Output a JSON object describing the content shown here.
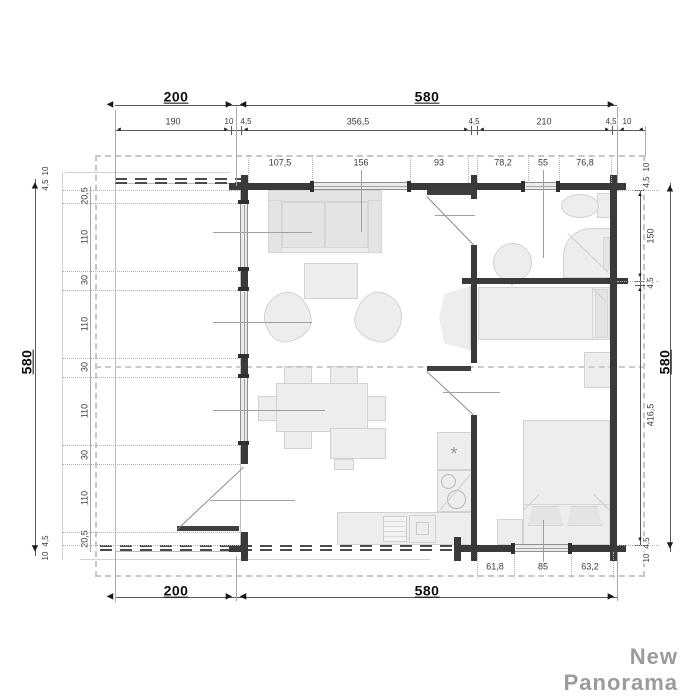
{
  "brand": "New Panorama",
  "symbols": {
    "kitchen_star": "*"
  },
  "colors": {
    "wall": "#3a3a3a",
    "furniture_fill": "#ededed",
    "furniture_border": "#d2d2d2",
    "dimension_text": "#3a3a3a",
    "overall_dimension_text": "#0d0d0d",
    "watermark": "#9b9b9b",
    "roof_dash": "#c7c7c7"
  },
  "overall_dimensions": {
    "terrace_width": "200",
    "cabin_width": "580",
    "depth_left": "580",
    "depth_right": "580"
  },
  "plan": {
    "labels": [
      {
        "t": "200",
        "x": 176,
        "y": 97,
        "b": 1
      },
      {
        "t": "580",
        "x": 427,
        "y": 97,
        "b": 1
      },
      {
        "t": "190",
        "x": 173,
        "y": 122
      },
      {
        "t": "10",
        "x": 229,
        "y": 122,
        "s": 1
      },
      {
        "t": "4,5",
        "x": 246,
        "y": 122,
        "s": 1
      },
      {
        "t": "356,5",
        "x": 358,
        "y": 122
      },
      {
        "t": "4,5",
        "x": 474,
        "y": 122,
        "s": 1
      },
      {
        "t": "210",
        "x": 544,
        "y": 122
      },
      {
        "t": "4,5",
        "x": 611,
        "y": 122,
        "s": 1
      },
      {
        "t": "10",
        "x": 627,
        "y": 122,
        "s": 1
      },
      {
        "t": "107,5",
        "x": 280,
        "y": 163
      },
      {
        "t": "156",
        "x": 361,
        "y": 163
      },
      {
        "t": "93",
        "x": 439,
        "y": 163
      },
      {
        "t": "78,2",
        "x": 503,
        "y": 163
      },
      {
        "t": "55",
        "x": 543,
        "y": 163
      },
      {
        "t": "76,8",
        "x": 585,
        "y": 163
      },
      {
        "t": "10",
        "x": 46,
        "y": 171,
        "r": 1,
        "s": 1
      },
      {
        "t": "4,5",
        "x": 46,
        "y": 185,
        "r": 1,
        "s": 1
      },
      {
        "t": "20,5",
        "x": 85,
        "y": 196,
        "r": 1
      },
      {
        "t": "110",
        "x": 85,
        "y": 237,
        "r": 1
      },
      {
        "t": "30",
        "x": 85,
        "y": 280,
        "r": 1
      },
      {
        "t": "110",
        "x": 85,
        "y": 324,
        "r": 1
      },
      {
        "t": "30",
        "x": 85,
        "y": 367,
        "r": 1
      },
      {
        "t": "110",
        "x": 85,
        "y": 411,
        "r": 1
      },
      {
        "t": "30",
        "x": 85,
        "y": 455,
        "r": 1
      },
      {
        "t": "110",
        "x": 85,
        "y": 498,
        "r": 1
      },
      {
        "t": "20,5",
        "x": 85,
        "y": 539,
        "r": 1
      },
      {
        "t": "4,5",
        "x": 46,
        "y": 541,
        "r": 1,
        "s": 1
      },
      {
        "t": "10",
        "x": 46,
        "y": 556,
        "r": 1,
        "s": 1
      },
      {
        "t": "580",
        "x": 27,
        "y": 362,
        "r": 1,
        "b": 1
      },
      {
        "t": "10",
        "x": 647,
        "y": 167,
        "r": 1,
        "s": 1
      },
      {
        "t": "4,5",
        "x": 647,
        "y": 182,
        "r": 1,
        "s": 1
      },
      {
        "t": "150",
        "x": 651,
        "y": 236,
        "r": 1
      },
      {
        "t": "4,5",
        "x": 651,
        "y": 283,
        "r": 1,
        "s": 1
      },
      {
        "t": "416,5",
        "x": 651,
        "y": 415,
        "r": 1
      },
      {
        "t": "4,5",
        "x": 647,
        "y": 543,
        "r": 1,
        "s": 1
      },
      {
        "t": "10",
        "x": 647,
        "y": 558,
        "r": 1,
        "s": 1
      },
      {
        "t": "580",
        "x": 665,
        "y": 362,
        "r": 1,
        "b": 1
      },
      {
        "t": "61,8",
        "x": 495,
        "y": 567
      },
      {
        "t": "85",
        "x": 543,
        "y": 567
      },
      {
        "t": "63,2",
        "x": 590,
        "y": 567
      },
      {
        "t": "200",
        "x": 176,
        "y": 591,
        "b": 1
      },
      {
        "t": "580",
        "x": 427,
        "y": 591,
        "b": 1
      }
    ],
    "arrows": [
      {
        "g": "◄",
        "x": 110,
        "y": 105
      },
      {
        "g": "►",
        "x": 229,
        "y": 105
      },
      {
        "g": "◄",
        "x": 243,
        "y": 105
      },
      {
        "g": "►",
        "x": 611,
        "y": 105
      },
      {
        "g": "◄",
        "x": 110,
        "y": 597
      },
      {
        "g": "►",
        "x": 229,
        "y": 597
      },
      {
        "g": "◄",
        "x": 243,
        "y": 597
      },
      {
        "g": "►",
        "x": 611,
        "y": 597
      },
      {
        "g": "▲",
        "x": 35,
        "y": 186
      },
      {
        "g": "▼",
        "x": 35,
        "y": 549
      },
      {
        "g": "▲",
        "x": 670,
        "y": 189
      },
      {
        "g": "▼",
        "x": 670,
        "y": 546
      },
      {
        "g": "◄",
        "x": 119,
        "y": 130,
        "z": 6
      },
      {
        "g": "►",
        "x": 226,
        "y": 130,
        "z": 6
      },
      {
        "g": "◄",
        "x": 246,
        "y": 130,
        "z": 6
      },
      {
        "g": "►",
        "x": 466,
        "y": 130,
        "z": 6
      },
      {
        "g": "◄",
        "x": 482,
        "y": 130,
        "z": 6
      },
      {
        "g": "►",
        "x": 607,
        "y": 130,
        "z": 6
      },
      {
        "g": "◄",
        "x": 622,
        "y": 130,
        "z": 6
      },
      {
        "g": "◄",
        "x": 641,
        "y": 130,
        "z": 6
      },
      {
        "g": "▲",
        "x": 640,
        "y": 195,
        "z": 6
      },
      {
        "g": "▼",
        "x": 640,
        "y": 276,
        "z": 6
      },
      {
        "g": "▲",
        "x": 640,
        "y": 290,
        "z": 6
      },
      {
        "g": "▼",
        "x": 640,
        "y": 540,
        "z": 6
      }
    ],
    "lines": {
      "dim": [
        {
          "x": 115,
          "y": 105,
          "w": 502,
          "h": 1
        },
        {
          "x": 115,
          "y": 130,
          "w": 530,
          "h": 1
        },
        {
          "x": 115,
          "y": 597,
          "w": 502,
          "h": 1
        },
        {
          "x": 35,
          "y": 179,
          "w": 1,
          "h": 377
        },
        {
          "x": 670,
          "y": 183,
          "w": 1,
          "h": 369
        },
        {
          "x": 640,
          "y": 190,
          "w": 1,
          "h": 355
        }
      ],
      "tick": [
        {
          "x": 115,
          "y": 126,
          "w": 1,
          "h": 9
        },
        {
          "x": 231,
          "y": 126,
          "w": 1,
          "h": 9
        },
        {
          "x": 241,
          "y": 126,
          "w": 1,
          "h": 9
        },
        {
          "x": 471,
          "y": 126,
          "w": 1,
          "h": 9
        },
        {
          "x": 477,
          "y": 126,
          "w": 1,
          "h": 9
        },
        {
          "x": 612,
          "y": 126,
          "w": 1,
          "h": 9
        },
        {
          "x": 617,
          "y": 126,
          "w": 1,
          "h": 9
        },
        {
          "x": 645,
          "y": 126,
          "w": 1,
          "h": 9
        },
        {
          "x": 635,
          "y": 190,
          "w": 10,
          "h": 1
        },
        {
          "x": 635,
          "y": 281,
          "w": 10,
          "h": 1
        },
        {
          "x": 635,
          "y": 285,
          "w": 10,
          "h": 1
        },
        {
          "x": 635,
          "y": 545,
          "w": 10,
          "h": 1
        }
      ],
      "witness": [
        {
          "x": 115,
          "y": 110,
          "w": 1,
          "h": 73
        },
        {
          "x": 236,
          "y": 107,
          "w": 1,
          "h": 79
        },
        {
          "x": 617,
          "y": 107,
          "w": 1,
          "h": 76
        },
        {
          "x": 645,
          "y": 126,
          "w": 1,
          "h": 30
        },
        {
          "x": 115,
          "y": 552,
          "w": 1,
          "h": 50
        },
        {
          "x": 236,
          "y": 556,
          "w": 1,
          "h": 45
        },
        {
          "x": 617,
          "y": 552,
          "w": 1,
          "h": 49
        },
        {
          "x": 90,
          "y": 186,
          "w": 1,
          "h": 366
        }
      ],
      "leader": [
        {
          "x": 213,
          "y": 232,
          "w": 99,
          "h": 1
        },
        {
          "x": 213,
          "y": 322,
          "w": 99,
          "h": 1
        },
        {
          "x": 213,
          "y": 410,
          "w": 112,
          "h": 1
        },
        {
          "x": 210,
          "y": 500,
          "w": 85,
          "h": 1
        },
        {
          "x": 361,
          "y": 170,
          "w": 1,
          "h": 62
        },
        {
          "x": 543,
          "y": 170,
          "w": 1,
          "h": 88
        },
        {
          "x": 543,
          "y": 520,
          "w": 1,
          "h": 42
        },
        {
          "x": 443,
          "y": 392,
          "w": 57,
          "h": 1
        },
        {
          "x": 435,
          "y": 215,
          "w": 40,
          "h": 1
        }
      ],
      "dotv": [
        {
          "x": 248,
          "y": 155,
          "w": 0,
          "h": 28
        },
        {
          "x": 312,
          "y": 155,
          "w": 0,
          "h": 28
        },
        {
          "x": 410,
          "y": 155,
          "w": 0,
          "h": 28
        },
        {
          "x": 468,
          "y": 155,
          "w": 0,
          "h": 28
        },
        {
          "x": 477,
          "y": 155,
          "w": 0,
          "h": 28
        },
        {
          "x": 528,
          "y": 155,
          "w": 0,
          "h": 28
        },
        {
          "x": 559,
          "y": 155,
          "w": 0,
          "h": 28
        },
        {
          "x": 611,
          "y": 155,
          "w": 0,
          "h": 28
        },
        {
          "x": 477,
          "y": 552,
          "w": 0,
          "h": 26
        },
        {
          "x": 514,
          "y": 552,
          "w": 0,
          "h": 26
        },
        {
          "x": 571,
          "y": 552,
          "w": 0,
          "h": 26
        },
        {
          "x": 613,
          "y": 552,
          "w": 0,
          "h": 26
        }
      ],
      "doth": [
        {
          "x": 62,
          "y": 190,
          "w": 178,
          "h": 0
        },
        {
          "x": 62,
          "y": 203,
          "w": 178,
          "h": 0
        },
        {
          "x": 62,
          "y": 271,
          "w": 178,
          "h": 0
        },
        {
          "x": 62,
          "y": 290,
          "w": 178,
          "h": 0
        },
        {
          "x": 62,
          "y": 358,
          "w": 178,
          "h": 0
        },
        {
          "x": 62,
          "y": 377,
          "w": 178,
          "h": 0
        },
        {
          "x": 62,
          "y": 445,
          "w": 178,
          "h": 0
        },
        {
          "x": 62,
          "y": 464,
          "w": 178,
          "h": 0
        },
        {
          "x": 62,
          "y": 532,
          "w": 178,
          "h": 0
        },
        {
          "x": 62,
          "y": 545,
          "w": 178,
          "h": 0
        },
        {
          "x": 617,
          "y": 190,
          "w": 42,
          "h": 0
        },
        {
          "x": 617,
          "y": 281,
          "w": 42,
          "h": 0
        },
        {
          "x": 617,
          "y": 545,
          "w": 42,
          "h": 0
        }
      ],
      "caps": [
        {
          "x": 310,
          "y": 181,
          "w": 4,
          "h": 11
        },
        {
          "x": 407,
          "y": 181,
          "w": 4,
          "h": 11
        },
        {
          "x": 521,
          "y": 181,
          "w": 4,
          "h": 11
        },
        {
          "x": 556,
          "y": 181,
          "w": 4,
          "h": 11
        },
        {
          "x": 511,
          "y": 543,
          "w": 4,
          "h": 11
        },
        {
          "x": 568,
          "y": 543,
          "w": 4,
          "h": 11
        },
        {
          "x": 238,
          "y": 200,
          "w": 11,
          "h": 4
        },
        {
          "x": 238,
          "y": 267,
          "w": 11,
          "h": 4
        },
        {
          "x": 238,
          "y": 287,
          "w": 11,
          "h": 4
        },
        {
          "x": 238,
          "y": 354,
          "w": 11,
          "h": 4
        },
        {
          "x": 238,
          "y": 374,
          "w": 11,
          "h": 4
        },
        {
          "x": 238,
          "y": 441,
          "w": 11,
          "h": 4
        }
      ]
    }
  }
}
